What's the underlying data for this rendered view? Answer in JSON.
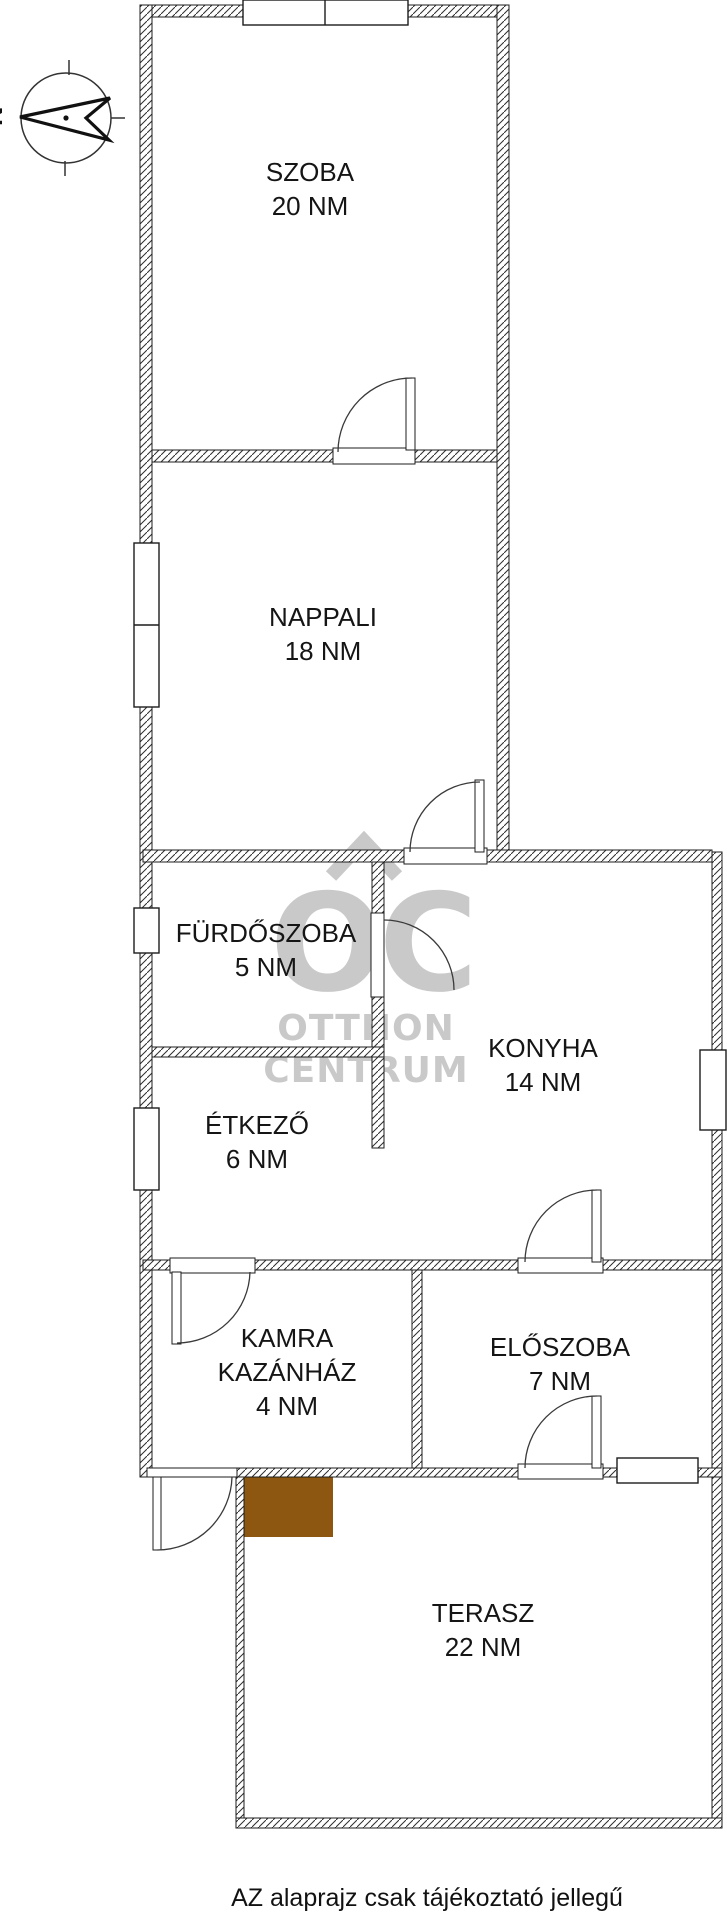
{
  "compass": {
    "north_label": "N"
  },
  "watermark": {
    "logo": "OC",
    "line1": "OTTHON",
    "line2": "CENTRUM"
  },
  "rooms": {
    "szoba": {
      "name": "SZOBA",
      "area": "20 NM"
    },
    "nappali": {
      "name": "NAPPALI",
      "area": "18 NM"
    },
    "furdoszoba": {
      "name": "FÜRDŐSZOBA",
      "area": "5 NM"
    },
    "konyha": {
      "name": "KONYHA",
      "area": "14 NM"
    },
    "etkezo": {
      "name": "ÉTKEZŐ",
      "area": "6 NM"
    },
    "kamra": {
      "line1": "KAMRA",
      "line2": "KAZÁNHÁZ",
      "area": "4 NM"
    },
    "eloszoba": {
      "name": "ELŐSZOBA",
      "area": "7 NM"
    },
    "terasz": {
      "name": "TERASZ",
      "area": "22 NM"
    }
  },
  "footer": {
    "disclaimer": "AZ alaprajz csak tájékoztató jellegű"
  },
  "colors": {
    "wall_line": "#1c1c1c",
    "watermark_gray": "#c9c9c9",
    "boiler_brown": "#8e5711"
  }
}
